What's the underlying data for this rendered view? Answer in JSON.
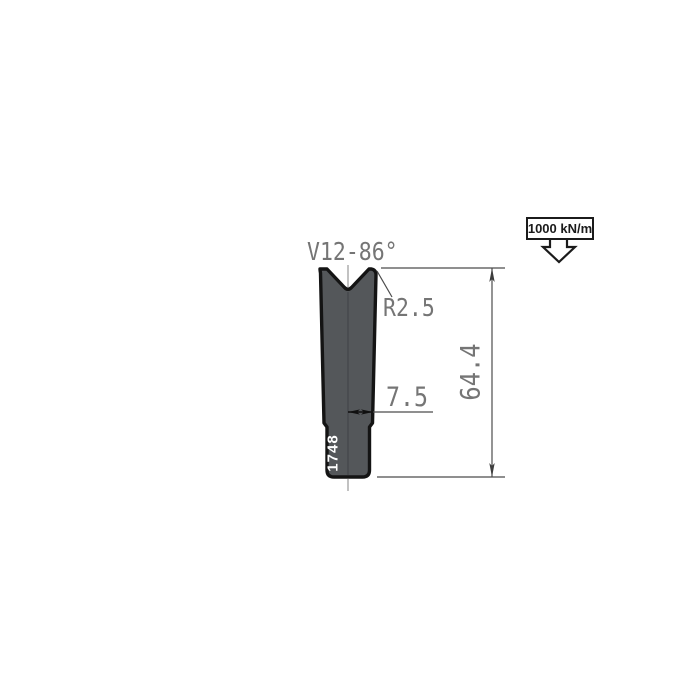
{
  "drawing": {
    "type_label": "V12-86°",
    "radius_label": "R2.5",
    "half_width_label": "7.5",
    "height_label": "64.4",
    "part_number": "1748",
    "force_rating": "1000 kN/m"
  },
  "dimensions_shown": {
    "v_opening_and_angle": "V12-86°",
    "shoulder_radius_mm": 2.5,
    "center_to_edge_mm": 7.5,
    "total_height_mm": 64.4,
    "max_load": "1000 kN/m"
  },
  "colors": {
    "background": "#ffffff",
    "die_fill": "#54575a",
    "die_outline": "#141414",
    "dimension_lines": "#4c4c4c",
    "label_text": "#757575",
    "centerline": "#a8a8a8",
    "part_number_text": "#ffffff",
    "force_box_border": "#1b1b1b"
  }
}
